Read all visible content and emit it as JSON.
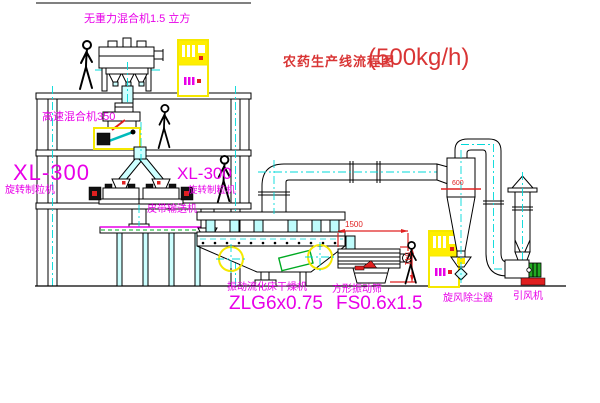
{
  "title": {
    "name": "农药生产线流程图",
    "capacity": "(500kg/h)"
  },
  "labels": {
    "gravity_mixer": "无重力混合机1.5 立方",
    "high_speed_mixer": "高速混合机350",
    "granulator_left_model": "XL-300",
    "granulator_left_name": "旋转制粒机",
    "granulator_right_model": "XL-300",
    "granulator_right_name": "旋转制粒机",
    "belt_conveyor": "皮带输送机",
    "dryer_name": "振动流化床干燥机",
    "dryer_model": "ZLG6x0.75",
    "sieve_name": "方形振动筛",
    "sieve_model": "FS0.6x1.5",
    "cyclone": "旋风除尘器",
    "fan": "引风机"
  },
  "dimensions": {
    "sieve_length": "1500",
    "sieve_height": "541",
    "cyclone_inlet": "600"
  },
  "colors": {
    "label_magenta": "#e800e8",
    "title_red": "#d93535",
    "dimension_red": "#e02020",
    "centerline_cyan": "#00d9d9",
    "highlight_yellow": "#f5e800",
    "chute_cyan_fill": "#ccffff",
    "machine_green": "#00aa22",
    "line_black": "#000000"
  }
}
